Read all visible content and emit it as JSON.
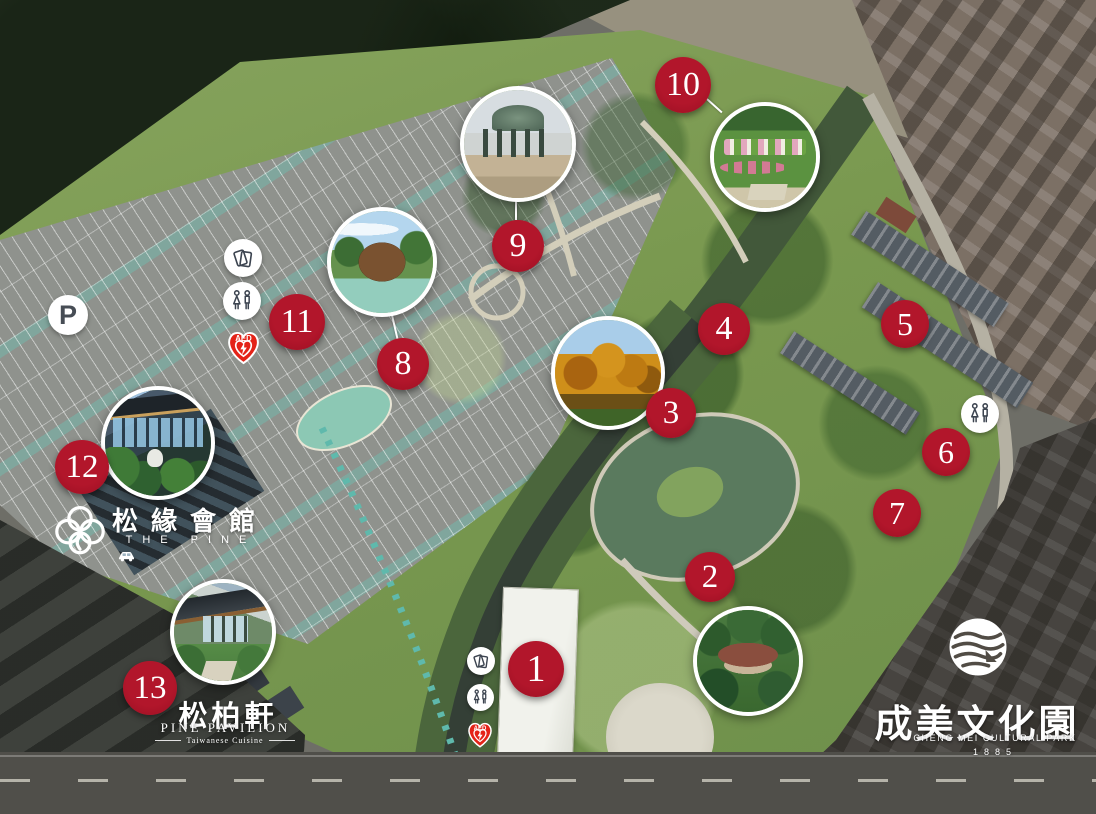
{
  "markers": [
    {
      "label": "1"
    },
    {
      "label": "2"
    },
    {
      "label": "3"
    },
    {
      "label": "4"
    },
    {
      "label": "5"
    },
    {
      "label": "6"
    },
    {
      "label": "7"
    },
    {
      "label": "8"
    },
    {
      "label": "9"
    },
    {
      "label": "10"
    },
    {
      "label": "11"
    },
    {
      "label": "12"
    },
    {
      "label": "13"
    }
  ],
  "photo_insets": [
    {
      "id": "2",
      "depicts": "traditional tile-roof house in pine garden"
    },
    {
      "id": "3",
      "depicts": "autumn bald cypress trees"
    },
    {
      "id": "8",
      "depicts": "wooden dome art pavilion beside pond"
    },
    {
      "id": "9",
      "depicts": "mosaic dome gazebo"
    },
    {
      "id": "10",
      "depicts": "flower garden with planted greeting text"
    },
    {
      "id": "12",
      "depicts": "glass banquet hall surrounded by pines"
    },
    {
      "id": "13",
      "depicts": "modern garden tea pavilion"
    }
  ],
  "icons": {
    "parking_label": "P",
    "aed_label": "AED"
  },
  "venues": {
    "the_pine": {
      "name_zh": "松緣會館",
      "name_en": "THE PINE"
    },
    "pine_pavilion": {
      "name_zh": "松柏軒",
      "name_en": "PINE PAVILION",
      "tagline": "Taiwanese Cuisine"
    },
    "cheng_mei": {
      "name_zh": "成美文化園",
      "name_en": "CHENG MEI CULTURAL PARK",
      "year": "1885"
    }
  },
  "colors": {
    "marker-red": "#b2162b",
    "aed-red": "#e42318",
    "park-green": "#7c9a56"
  }
}
